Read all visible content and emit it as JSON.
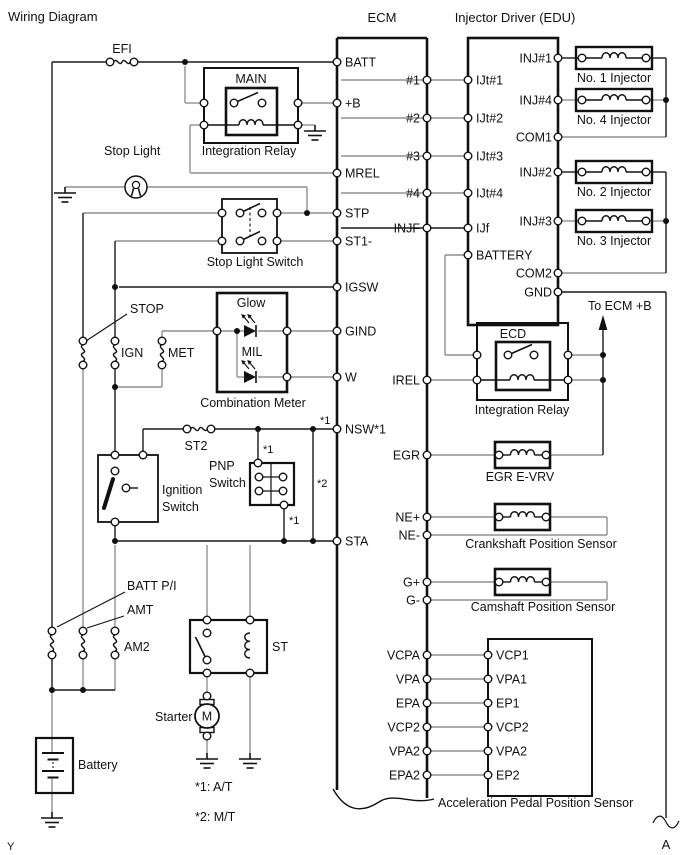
{
  "title": "Wiring Diagram",
  "page_marker": "Y",
  "connector_a": "A",
  "notes": {
    "n1": "*1: A/T",
    "n2": "*2: M/T"
  },
  "annotations": {
    "star1": "*1",
    "star2": "*2",
    "to_ecm_b": "To ECM +B"
  },
  "colors": {
    "line": "#1a1a1a",
    "wire_gray": "#909090",
    "bg": "#ffffff"
  },
  "ecm": {
    "label": "ECM",
    "pins_left": {
      "batt": "BATT",
      "plus_b": "+B",
      "mrel": "MREL",
      "stp": "STP",
      "st1": "ST1-",
      "igsw": "IGSW",
      "gind": "GIND",
      "w": "W",
      "nsw": "NSW*1",
      "sta": "STA"
    },
    "pins_right": {
      "p1": "#1",
      "p2": "#2",
      "p3": "#3",
      "p4": "#4",
      "injf": "INJF",
      "irel": "IREL",
      "egr": "EGR",
      "ne_p": "NE+",
      "ne_m": "NE-",
      "g_p": "G+",
      "g_m": "G-",
      "vcpa": "VCPA",
      "vpa": "VPA",
      "epa": "EPA",
      "vcp2": "VCP2",
      "vpa2": "VPA2",
      "epa2": "EPA2"
    }
  },
  "edu": {
    "label": "Injector Driver (EDU)",
    "pins_left": {
      "ijt1": "IJt#1",
      "ijt2": "IJt#2",
      "ijt3": "IJt#3",
      "ijt4": "IJt#4",
      "ijf": "IJf",
      "battery": "BATTERY"
    },
    "pins_right": {
      "inj1": "INJ#1",
      "inj4": "INJ#4",
      "com1": "COM1",
      "inj2": "INJ#2",
      "inj3": "INJ#3",
      "com2": "COM2",
      "gnd": "GND"
    }
  },
  "injectors": {
    "no1": "No. 1 Injector",
    "no4": "No. 4 Injector",
    "no2": "No. 2 Injector",
    "no3": "No. 3 Injector"
  },
  "fuses": {
    "efi": "EFI",
    "stop": "STOP",
    "ign": "IGN",
    "met": "MET",
    "st2": "ST2",
    "batt_pi": "BATT P/I",
    "amt": "AMT",
    "am2": "AM2"
  },
  "components": {
    "main_relay": {
      "inner": "MAIN",
      "label": "Integration Relay"
    },
    "ecd_relay": {
      "inner": "ECD",
      "label": "Integration Relay"
    },
    "stop_light": "Stop Light",
    "stop_light_switch": "Stop Light Switch",
    "combination_meter": {
      "label": "Combination Meter",
      "glow": "Glow",
      "mil": "MIL"
    },
    "ignition_switch_1": "Ignition",
    "ignition_switch_2": "Switch",
    "pnp_switch_1": "PNP",
    "pnp_switch_2": "Switch",
    "st_relay": "ST",
    "starter": "Starter",
    "starter_m": "M",
    "battery": "Battery",
    "egr_evrv": "EGR E-VRV",
    "crankshaft_sensor": "Crankshaft Position Sensor",
    "camshaft_sensor": "Camshaft Position Sensor",
    "app_sensor": "Acceleration Pedal Position Sensor"
  },
  "app_pins": {
    "vcp1": "VCP1",
    "vpa1": "VPA1",
    "ep1": "EP1",
    "vcp2": "VCP2",
    "vpa2": "VPA2",
    "ep2": "EP2"
  }
}
